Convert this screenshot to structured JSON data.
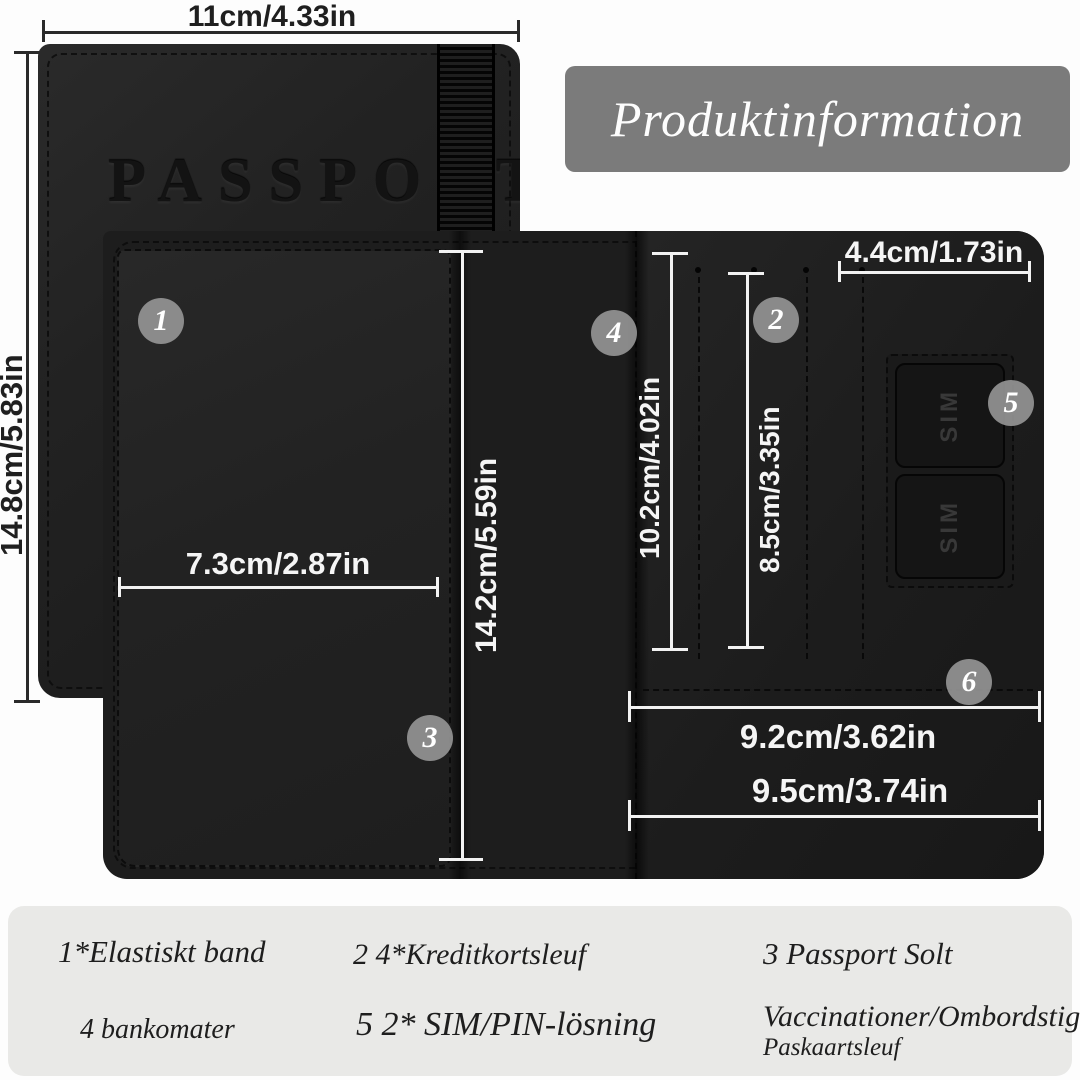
{
  "title": "Produktinformation",
  "product": {
    "cover_text": "PASSPORT",
    "sim_label_1": "SIM",
    "sim_label_2": "SIM"
  },
  "dimensions": {
    "cover_width": "11cm/4.33in",
    "cover_height": "14.8cm/5.83in",
    "interior_height": "14.2cm/5.59in",
    "slot_column_height": "10.2cm/4.02in",
    "card_slot_height": "8.5cm/3.35in",
    "sim_patch_width": "4.4cm/1.73in",
    "left_pocket_width": "7.3cm/2.87in",
    "inner_pocket_width": "9.2cm/3.62in",
    "outer_pocket_width": "9.5cm/3.74in"
  },
  "callouts": {
    "c1": "1",
    "c2": "2",
    "c3": "3",
    "c4": "4",
    "c5": "5",
    "c6": "6"
  },
  "legend": {
    "item1": "1*Elastiskt band",
    "item2": "2 4*Kreditkortsleuf",
    "item3": "3 Passport Solt",
    "item4": "4 bankomater",
    "item5": "5 2* SIM/PIN-lösning",
    "item6_line1": "Vaccinationer/Ombordstigning",
    "item6_line2": "Paskaartsleuf"
  },
  "colors": {
    "title_bg": "#7b7b7b",
    "leather_black": "#1d1d1d",
    "legend_bg": "#e9e9e7",
    "measure_light": "#f2f2f2",
    "measure_dark": "#2a2a2a",
    "callout_bg": "#949494"
  }
}
